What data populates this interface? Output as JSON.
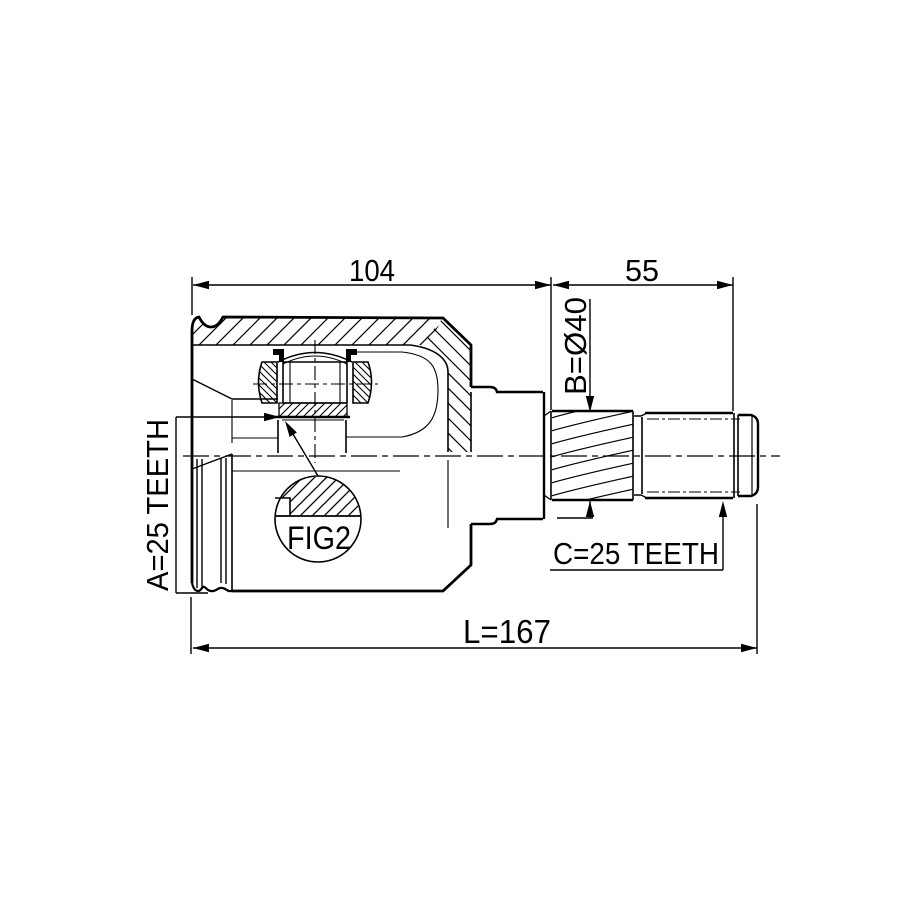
{
  "canvas": {
    "background": "#ffffff",
    "ink": "#000000",
    "width": 915,
    "height": 915
  },
  "drawing": {
    "kind": "cv-joint-half-section",
    "labels": {
      "dim_104": "104",
      "dim_55": "55",
      "dim_b": "B=Ø40",
      "dim_a": "A=25 TEETH",
      "dim_c": "C=25 TEETH",
      "dim_l": "L=167",
      "fig_ref": "FIG2"
    }
  }
}
